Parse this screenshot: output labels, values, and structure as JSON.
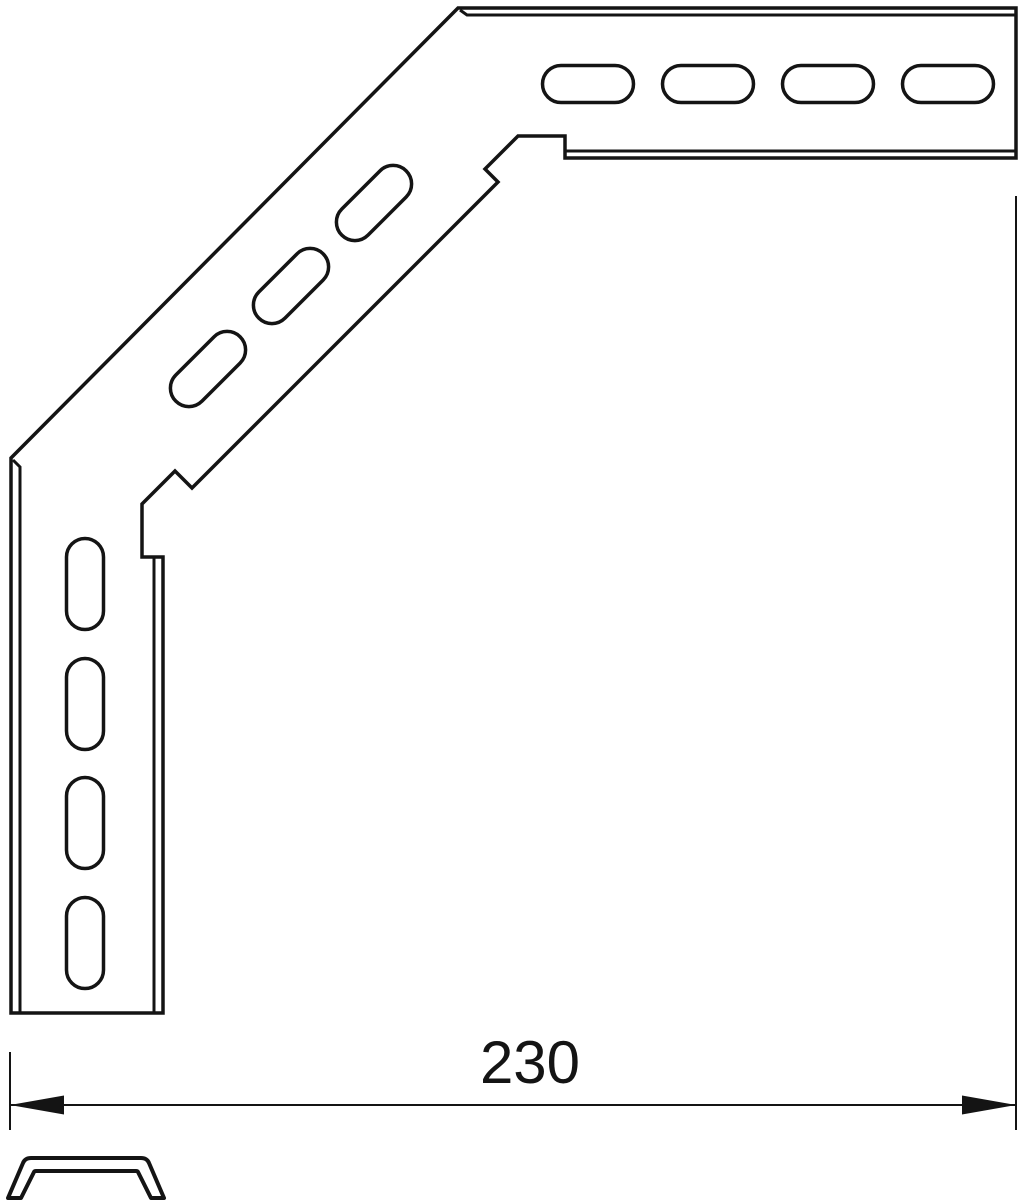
{
  "page": {
    "width": 1023,
    "height": 1200,
    "background": "#ffffff",
    "line_color": "#141414"
  },
  "drawing": {
    "part": {
      "description": "90-degree slotted corner bracket, line drawing",
      "outline_points": [
        [
          458,
          8
        ],
        [
          1016,
          8
        ],
        [
          1016,
          158
        ],
        [
          565,
          158
        ],
        [
          565,
          136
        ],
        [
          518,
          136
        ],
        [
          485,
          169
        ],
        [
          498,
          182
        ],
        [
          192,
          488
        ],
        [
          175,
          471
        ],
        [
          142,
          504
        ],
        [
          142,
          557
        ],
        [
          163,
          557
        ],
        [
          163,
          1013
        ],
        [
          11,
          1013
        ],
        [
          11,
          458
        ]
      ],
      "thickness_lines": [
        [
          [
            460,
            10
          ],
          [
            467,
            15
          ],
          [
            1016,
            15
          ]
        ],
        [
          [
            565,
            151
          ],
          [
            1016,
            151
          ]
        ],
        [
          [
            154,
            557
          ],
          [
            154,
            1013
          ]
        ],
        [
          [
            13,
            460
          ],
          [
            20,
            467
          ],
          [
            20,
            1013
          ]
        ]
      ],
      "slots": [
        {
          "cx": 588,
          "cy": 84,
          "w": 91,
          "h": 37,
          "angle": 0
        },
        {
          "cx": 708,
          "cy": 84,
          "w": 91,
          "h": 37,
          "angle": 0
        },
        {
          "cx": 828,
          "cy": 84,
          "w": 91,
          "h": 37,
          "angle": 0
        },
        {
          "cx": 948,
          "cy": 84,
          "w": 91,
          "h": 37,
          "angle": 0
        },
        {
          "cx": 374,
          "cy": 203,
          "w": 91,
          "h": 37,
          "angle": -45
        },
        {
          "cx": 291,
          "cy": 286,
          "w": 91,
          "h": 37,
          "angle": -45
        },
        {
          "cx": 208,
          "cy": 369,
          "w": 91,
          "h": 37,
          "angle": -45
        },
        {
          "cx": 85,
          "cy": 584,
          "w": 37,
          "h": 91,
          "angle": 0
        },
        {
          "cx": 85,
          "cy": 704,
          "w": 37,
          "h": 91,
          "angle": 0
        },
        {
          "cx": 85,
          "cy": 823,
          "w": 37,
          "h": 91,
          "angle": 0
        },
        {
          "cx": 85,
          "cy": 943,
          "w": 37,
          "h": 91,
          "angle": 0
        }
      ],
      "outline_stroke_width": 3.5,
      "thickness_stroke_width": 3
    },
    "dimension": {
      "label": "230",
      "line_y": 1105,
      "x_left": 10,
      "x_right": 1016,
      "ext_left": {
        "x": 10,
        "y1": 1052,
        "y2": 1130
      },
      "ext_right": {
        "x": 1016,
        "y1": 196,
        "y2": 1130
      },
      "arrow_length": 54,
      "arrow_half_width": 9.5,
      "label_x": 530,
      "label_y": 1083,
      "font_size": 60,
      "stroke_width": 2
    },
    "profile": {
      "description": "end profile cross-section of bracket rail",
      "path": "M 8,1198 L 23,1163 Q 25,1158 31,1158 L 141,1158 Q 147,1158 149,1163 L 164,1198 L 151,1198 L 138,1172 Q 137.5,1171 136,1171 L 36,1171 Q 34.5,1171 34,1172 L 21,1198 Z",
      "stroke_width": 4
    }
  }
}
